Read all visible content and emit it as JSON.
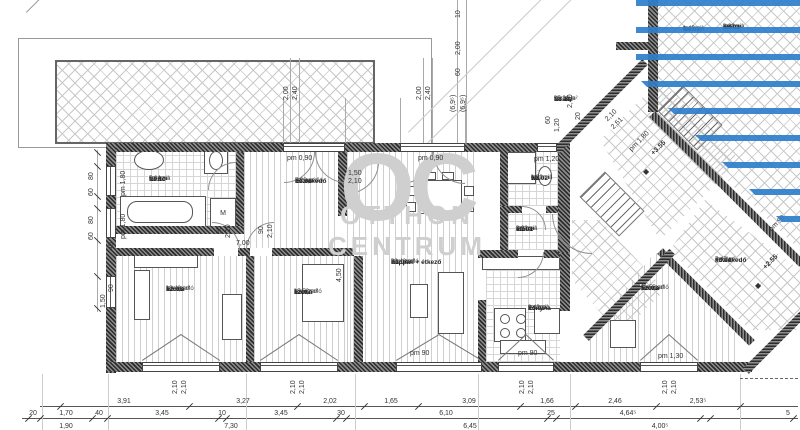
{
  "watermark": {
    "initials": "OC",
    "line1": "OTTHON",
    "line2": "CENTRUM"
  },
  "colors": {
    "stripe_blue": "#2d7ecc",
    "watermark_gray": "#cfcfcf",
    "wall_dark": "#2c2c2c"
  },
  "symbols": {
    "level_marker": "◆",
    "washer_label": "M"
  },
  "rooms": [
    {
      "id": "E3.11",
      "name": "terasz",
      "finish": "kerámia",
      "area": "25,31 m²",
      "x": 553,
      "y": 95
    },
    {
      "id": "E3.10",
      "name": "fürdő",
      "finish": "kerámia",
      "area": "5,64 m²",
      "x": 148,
      "y": 175
    },
    {
      "id": "E3.06",
      "name": "közlekedő",
      "finish": "lam. padló",
      "area": "7,28 m²",
      "x": 294,
      "y": 177
    },
    {
      "id": "E3.04",
      "name": "nappali + étkező",
      "finish": "lam. padló",
      "area": "20,42 m²",
      "x": 390,
      "y": 258
    },
    {
      "id": "E3.08",
      "name": "szoba",
      "finish": "lam. padló",
      "area": "13,40 m²",
      "x": 165,
      "y": 285
    },
    {
      "id": "E3.07",
      "name": "szoba",
      "finish": "lam. padló",
      "area": "15,53 m²",
      "x": 293,
      "y": 288
    },
    {
      "id": "E3.05",
      "name": "konyha",
      "finish": "kerámia",
      "area": "9,43 m²",
      "x": 527,
      "y": 304
    },
    {
      "id": "E3.02",
      "name": "wc",
      "finish": "kerámia",
      "area": "1,39 m²",
      "x": 530,
      "y": 174
    },
    {
      "id": "E3.01",
      "name": "előtér",
      "finish": "kerámia",
      "area": "2,92 m²",
      "x": 515,
      "y": 225
    },
    {
      "id": "E3.03",
      "name": "szoba",
      "finish": "lam. padló",
      "area": "11,55 m²",
      "x": 640,
      "y": 284
    },
    {
      "id": "E4.02",
      "name": "wc",
      "finish": "kerámia",
      "area": "1,45 m²",
      "x": 682,
      "y": 25
    },
    {
      "id": "E4.01",
      "name": "előtér",
      "finish": "kerámia",
      "area": "2,92 m²",
      "x": 722,
      "y": 23
    },
    {
      "id": "F3.01",
      "name": "közlekedő",
      "finish": "greslap",
      "area": "7,47 m²",
      "x": 714,
      "y": 256
    }
  ],
  "elevations": [
    {
      "label": "+3.55",
      "x": 650,
      "y": 152
    },
    {
      "label": "+2.55",
      "x": 762,
      "y": 266
    }
  ],
  "dim_rows": {
    "row1": [
      [
        "3,91",
        124
      ],
      [
        "3,27",
        243
      ],
      [
        "2,02",
        330
      ],
      [
        "1,65",
        391
      ],
      [
        "3,09",
        469
      ],
      [
        "1,66",
        547
      ],
      [
        "2,46",
        615
      ],
      [
        "2,53⁵",
        698
      ]
    ],
    "row2": [
      [
        "20",
        33
      ],
      [
        "1,70",
        66
      ],
      [
        "40",
        99
      ],
      [
        "3,45",
        162
      ],
      [
        "10",
        222
      ],
      [
        "3,45",
        281
      ],
      [
        "30",
        341
      ],
      [
        "6,10",
        446
      ],
      [
        "25",
        551
      ],
      [
        "4,64⁵",
        628
      ],
      [
        "5",
        788
      ]
    ],
    "row3": [
      [
        "1,90",
        66
      ],
      [
        "7,30",
        231
      ],
      [
        "6,45",
        470
      ],
      [
        "4,00⁵",
        660
      ]
    ]
  },
  "dim_labels": [
    {
      "t": "pm 1,80",
      "x": 120,
      "y": 196,
      "r": -90
    },
    {
      "t": "pm 1,80",
      "x": 120,
      "y": 239,
      "r": -90
    },
    {
      "t": "80",
      "x": 88,
      "y": 180,
      "r": -90
    },
    {
      "t": "60",
      "x": 88,
      "y": 196,
      "r": -90
    },
    {
      "t": "80",
      "x": 88,
      "y": 224,
      "r": -90
    },
    {
      "t": "60",
      "x": 88,
      "y": 240,
      "r": -90
    },
    {
      "t": "40",
      "x": 108,
      "y": 250,
      "r": -90
    },
    {
      "t": "90",
      "x": 108,
      "y": 292,
      "r": -90
    },
    {
      "t": "1,50",
      "x": 100,
      "y": 308,
      "r": -90
    },
    {
      "t": "pm 0,90",
      "x": 287,
      "y": 155,
      "r": 0
    },
    {
      "t": "pm 0,90",
      "x": 418,
      "y": 155,
      "r": 0
    },
    {
      "t": "pm 1,20",
      "x": 534,
      "y": 156,
      "r": 0
    },
    {
      "t": "2,00",
      "x": 283,
      "y": 100,
      "r": -90
    },
    {
      "t": "2,40",
      "x": 292,
      "y": 100,
      "r": -90
    },
    {
      "t": "2,00",
      "x": 416,
      "y": 100,
      "r": -90
    },
    {
      "t": "2,40",
      "x": 425,
      "y": 100,
      "r": -90
    },
    {
      "t": "10",
      "x": 455,
      "y": 18,
      "r": -90
    },
    {
      "t": "2,00",
      "x": 455,
      "y": 55,
      "r": -90
    },
    {
      "t": "60",
      "x": 455,
      "y": 76,
      "r": -90
    },
    {
      "t": "(6,9⁵)",
      "x": 450,
      "y": 112,
      "r": -90
    },
    {
      "t": "(6,9⁵)",
      "x": 460,
      "y": 112,
      "r": -90
    },
    {
      "t": "60",
      "x": 545,
      "y": 124,
      "r": -90
    },
    {
      "t": "1,20",
      "x": 554,
      "y": 132,
      "r": -90
    },
    {
      "t": "2,40",
      "x": 567,
      "y": 108,
      "r": -90
    },
    {
      "t": "20",
      "x": 575,
      "y": 120,
      "r": -90
    },
    {
      "t": "2,10",
      "x": 604,
      "y": 118,
      "r": -45
    },
    {
      "t": "2,51",
      "x": 610,
      "y": 126,
      "r": -45
    },
    {
      "t": "pm 1,80",
      "x": 628,
      "y": 148,
      "r": -45
    },
    {
      "t": "90",
      "x": 216,
      "y": 234,
      "r": -90
    },
    {
      "t": "2,10",
      "x": 225,
      "y": 238,
      "r": -90
    },
    {
      "t": "90",
      "x": 258,
      "y": 234,
      "r": -90
    },
    {
      "t": "2,10",
      "x": 267,
      "y": 238,
      "r": -90
    },
    {
      "t": "7,00",
      "x": 236,
      "y": 240,
      "r": 0
    },
    {
      "t": "1,50",
      "x": 348,
      "y": 170,
      "r": 0
    },
    {
      "t": "2,10",
      "x": 348,
      "y": 178,
      "r": 0
    },
    {
      "t": "4,50",
      "x": 336,
      "y": 282,
      "r": -90
    },
    {
      "t": "pm 90",
      "x": 410,
      "y": 350,
      "r": 0
    },
    {
      "t": "pm 90",
      "x": 518,
      "y": 350,
      "r": 0
    },
    {
      "t": "pm 1,30",
      "x": 658,
      "y": 353,
      "r": 0
    },
    {
      "t": "pm 90",
      "x": 768,
      "y": 228,
      "r": -45
    },
    {
      "t": "2,10",
      "x": 172,
      "y": 394,
      "r": -90
    },
    {
      "t": "2,10",
      "x": 181,
      "y": 394,
      "r": -90
    },
    {
      "t": "2,10",
      "x": 290,
      "y": 394,
      "r": -90
    },
    {
      "t": "2,10",
      "x": 299,
      "y": 394,
      "r": -90
    },
    {
      "t": "2,10",
      "x": 519,
      "y": 394,
      "r": -90
    },
    {
      "t": "2,10",
      "x": 528,
      "y": 394,
      "r": -90
    },
    {
      "t": "2,10",
      "x": 662,
      "y": 394,
      "r": -90
    },
    {
      "t": "2,10",
      "x": 671,
      "y": 394,
      "r": -90
    }
  ]
}
